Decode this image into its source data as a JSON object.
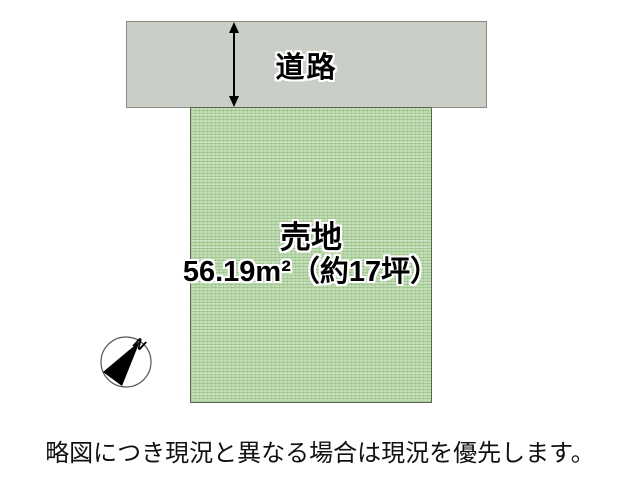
{
  "diagram": {
    "road_label": "道路",
    "plot": {
      "title": "売地",
      "size_text": "56.19m²（約17坪）"
    },
    "compass": {
      "north_label": "N"
    },
    "note": "略図につき現況と異なる場合は現況を優先します。",
    "colors": {
      "road_fill": "#c9cec6",
      "road_border": "#878c84",
      "plot_fill": "#c1ddb3",
      "plot_border": "#5d6756",
      "arrow": "#000000",
      "text": "#000000"
    }
  }
}
